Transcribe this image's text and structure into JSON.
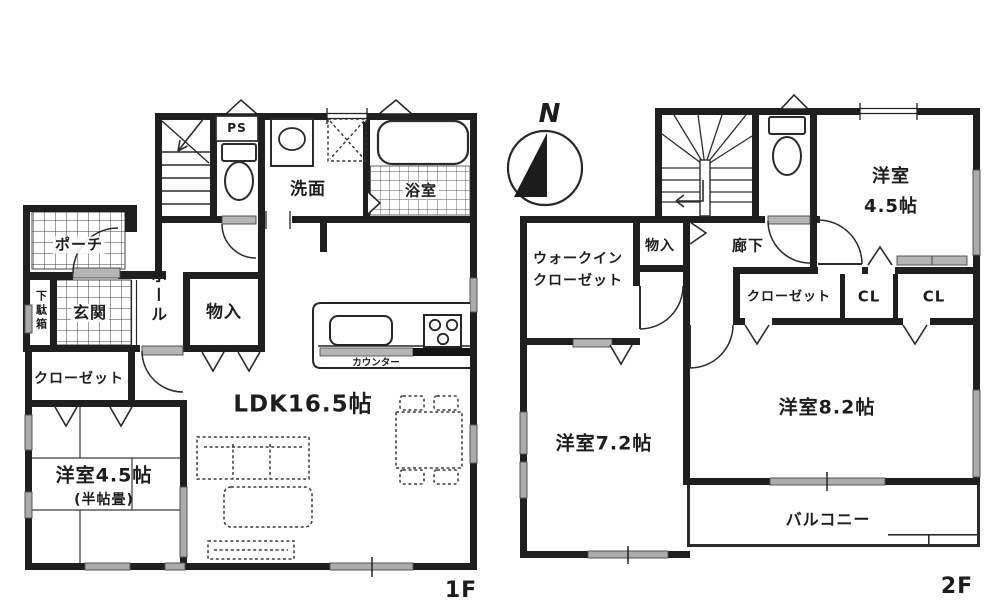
{
  "title": "2-story house floor plan",
  "compass": {
    "north_label": "N"
  },
  "colors": {
    "wall": "#1f1f1f",
    "window_gray": "#ababab",
    "door_gray": "#b5b5b5",
    "line": "#2b2b2b"
  },
  "floor1": {
    "floor_label": "1F",
    "rooms": {
      "porch": "ポーチ",
      "genkan": "玄関",
      "getabako": "下駄箱",
      "hall": "ホール",
      "monoire": "物入",
      "senmen": "洗面",
      "yokushitsu": "浴室",
      "ps": "PS",
      "closet": "クローゼット",
      "yoshitsu45": "洋室4.5帖",
      "yoshitsu45_sub": "(半帖畳)",
      "ldk": "LDK16.5帖",
      "counter": "カウンター"
    }
  },
  "floor2": {
    "floor_label": "2F",
    "rooms": {
      "wic_line1": "ウォークイン",
      "wic_line2": "クローゼット",
      "monoire": "物入",
      "rouka": "廊下",
      "yoshitsu45_line1": "洋室",
      "yoshitsu45_line2": "4.5帖",
      "closet": "クローゼット",
      "cl1": "CL",
      "cl2": "CL",
      "yoshitsu82": "洋室8.2帖",
      "yoshitsu72": "洋室7.2帖",
      "balcony": "バルコニー"
    }
  }
}
